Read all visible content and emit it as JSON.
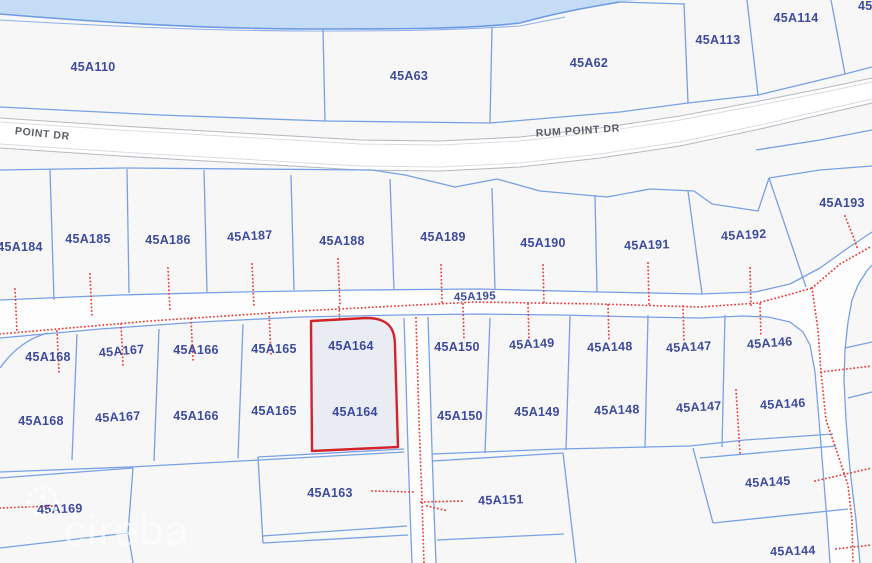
{
  "map": {
    "watermark": "cireba",
    "selected_parcel": "45A164",
    "roads": {
      "rum_point_dr": "RUM POINT DR",
      "rum_point_dr_partial": "POINT DR",
      "parcel_road": "45A195"
    },
    "parcels": {
      "a110": "45A110",
      "a63": "45A63",
      "a62": "45A62",
      "a113": "45A113",
      "a114": "45A114",
      "corner_partial": "45",
      "a184": "45A184",
      "a185": "45A185",
      "a186": "45A186",
      "a187": "45A187",
      "a188": "45A188",
      "a189": "45A189",
      "a190": "45A190",
      "a191": "45A191",
      "a192": "45A192",
      "a193": "45A193",
      "a168": "45A168",
      "a167": "45A167",
      "a166": "45A166",
      "a165": "45A165",
      "a164": "45A164",
      "a150": "45A150",
      "a149": "45A149",
      "a148": "45A148",
      "a147": "45A147",
      "a146": "45A146",
      "a169": "45A169",
      "a163": "45A163",
      "a151": "45A151",
      "a145": "45A145",
      "a144": "45A144"
    },
    "colors": {
      "water": "#c5dcf6",
      "shore_stroke": "#6d9ae3",
      "land": "#f7f7f8",
      "road_fill": "#ffffff",
      "parcel_line": "#7aa0e4",
      "label": "#3d4b9e",
      "road_label": "#5b6067",
      "utility_dotted": "#e8423d",
      "selected_outline": "#d2232b",
      "selected_fill": "#e9ecf3"
    }
  }
}
